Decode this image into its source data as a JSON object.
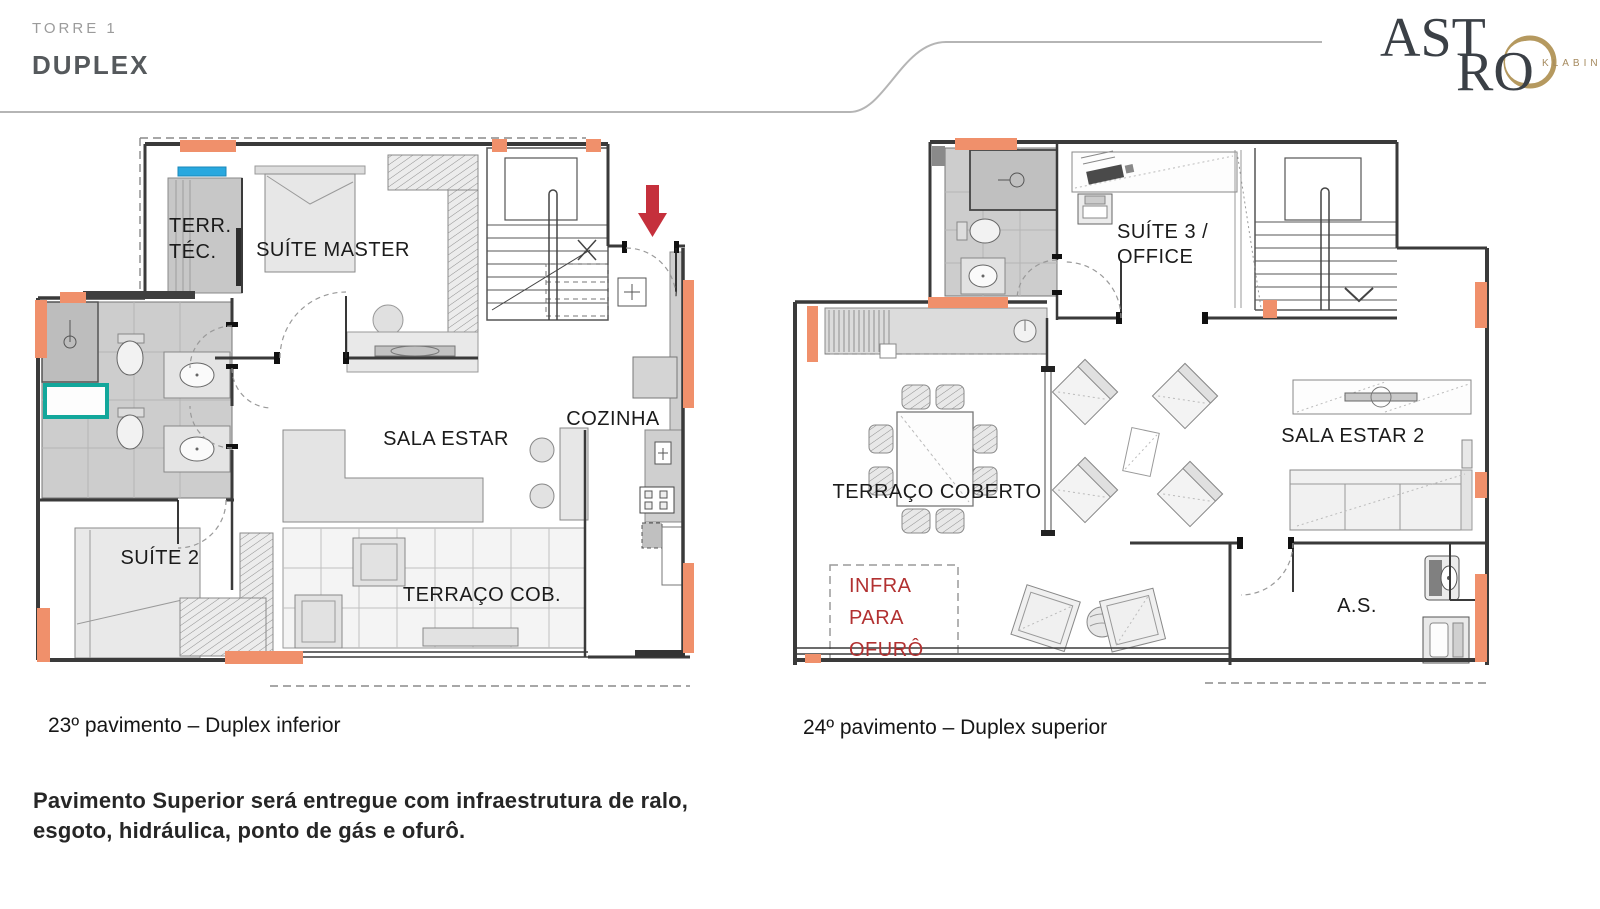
{
  "header": {
    "tower": "TORRE 1",
    "title": "DUPLEX"
  },
  "logo": {
    "word_1": "AST",
    "word_2": "RO",
    "sub": "KLABIN"
  },
  "plans": {
    "lower": {
      "caption": "23º pavimento – Duplex inferior",
      "rooms": {
        "terr_tec_1": "TERR.",
        "terr_tec_2": "TÉC.",
        "suite_master": "SUÍTE MASTER",
        "sala_estar": "SALA ESTAR",
        "cozinha": "COZINHA",
        "suite_2": "SUÍTE 2",
        "terraco_cob": "TERRAÇO COB."
      }
    },
    "upper": {
      "caption": "24º pavimento – Duplex superior",
      "rooms": {
        "suite3_1": "SUÍTE 3 /",
        "suite3_2": "OFFICE",
        "terraco_coberto": "TERRAÇO COBERTO",
        "sala_estar_2": "SALA ESTAR 2",
        "as": "A.S.",
        "infra_1": "INFRA",
        "infra_2": "PARA",
        "infra_3": "OFURÔ"
      }
    }
  },
  "note": {
    "line1": "Pavimento Superior será entregue com infraestrutura de ralo,",
    "line2": "esgoto, hidráulica, ponto de gás e ofurô."
  },
  "colors": {
    "accent_salmon": "#F0906B",
    "window_blue": "#29A8DF",
    "tub_teal": "#12A79B",
    "entry_arrow_red": "#C5303C",
    "infra_red": "#B23131",
    "logo_gold": "#B5995F",
    "wall_dark": "#3A3A3A"
  }
}
